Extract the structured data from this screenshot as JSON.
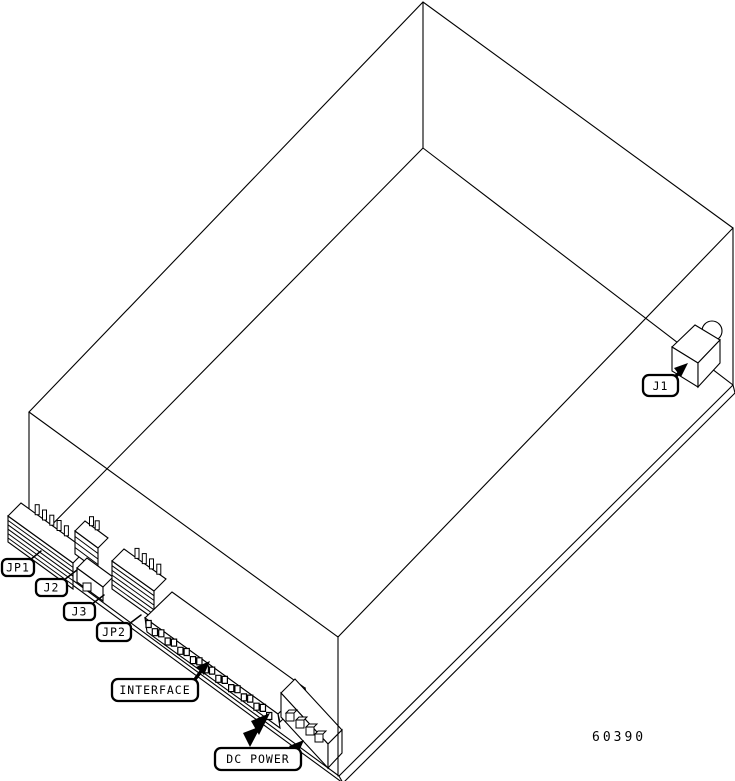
{
  "figure": {
    "number": "60390",
    "description": "isometric line drawing of chassis with connector callouts"
  },
  "colors": {
    "background": "#ffffff",
    "line": "#000000",
    "label_fill": "#ffffff"
  },
  "labels": {
    "jp1": "JP1",
    "j2": "J2",
    "j3": "J3",
    "jp2": "JP2",
    "interface": "INTERFACE",
    "dc_power": "DC POWER",
    "j1": "J1"
  }
}
